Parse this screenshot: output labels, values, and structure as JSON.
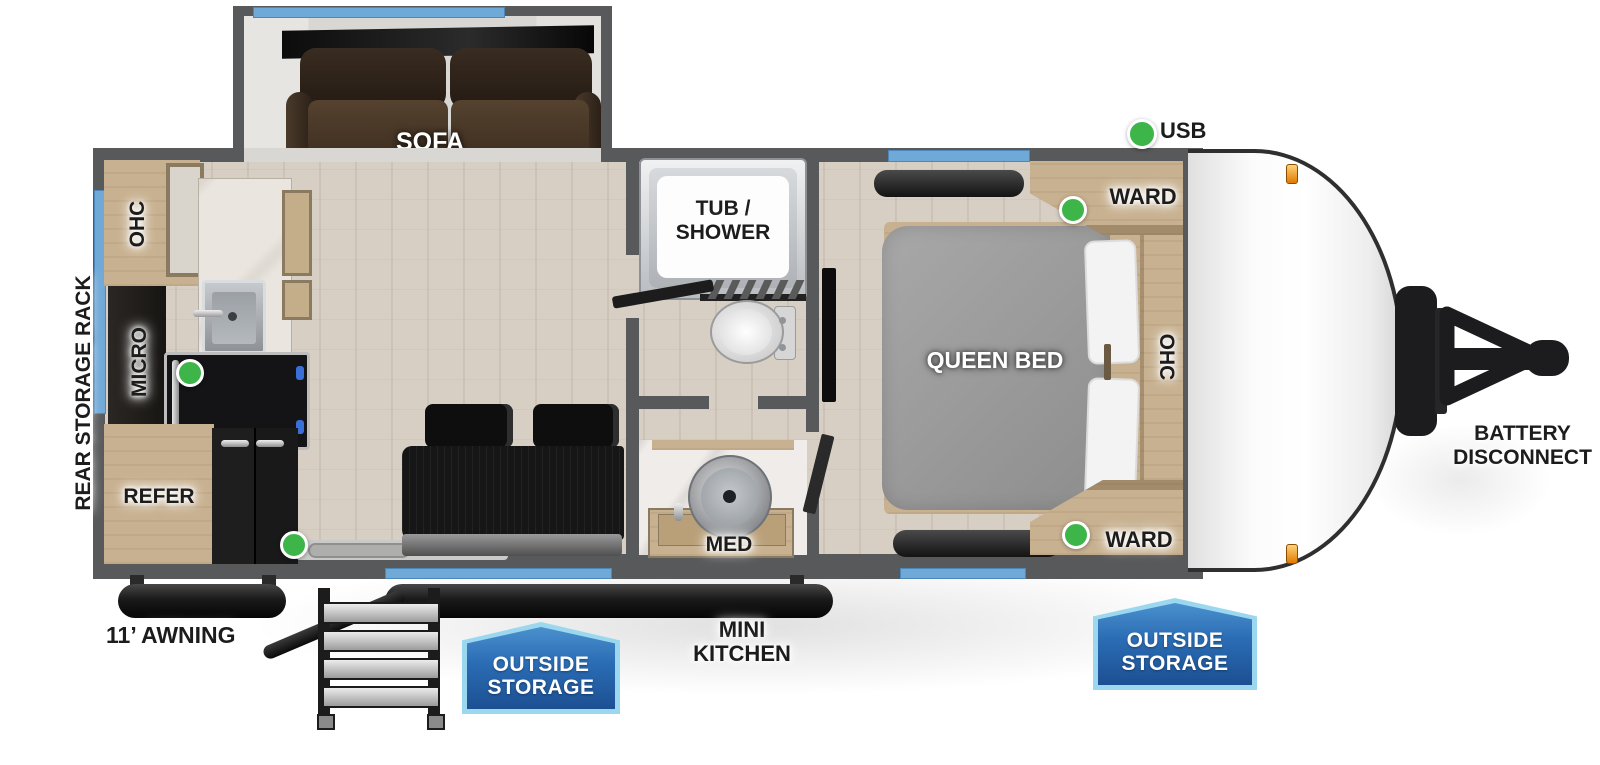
{
  "legend": {
    "usb_label": "USB",
    "usb_indicator_count": 4
  },
  "rooms": {
    "sofa": "SOFA",
    "kitchen": {
      "ohc": "OHC",
      "micro": "MICRO",
      "refer": "REFER"
    },
    "bath": {
      "tub_line1": "TUB /",
      "tub_line2": "SHOWER",
      "med": "MED"
    },
    "bedroom": {
      "queen_bed": "QUEEN BED",
      "ward_top": "WARD",
      "ward_bottom": "WARD",
      "ohc": "OHC"
    }
  },
  "exterior": {
    "rear_storage_rack": "REAR STORAGE RACK",
    "awning": "11’ AWNING",
    "mini_kitchen_line1": "MINI",
    "mini_kitchen_line2": "KITCHEN",
    "battery_line1": "BATTERY",
    "battery_line2": "DISCONNECT",
    "outside_storage_door": {
      "line1": "OUTSIDE",
      "line2": "STORAGE"
    },
    "outside_storage_front": {
      "line1": "OUTSIDE",
      "line2": "STORAGE"
    }
  },
  "colors": {
    "wall_gray": "#58595b",
    "window_blue": "#6fa9d8",
    "indicator_green": "#3db549",
    "badge_blue": "#2a6cb4",
    "badge_border_blue": "#9bd8f0",
    "marker_orange": "#f3a01c"
  }
}
